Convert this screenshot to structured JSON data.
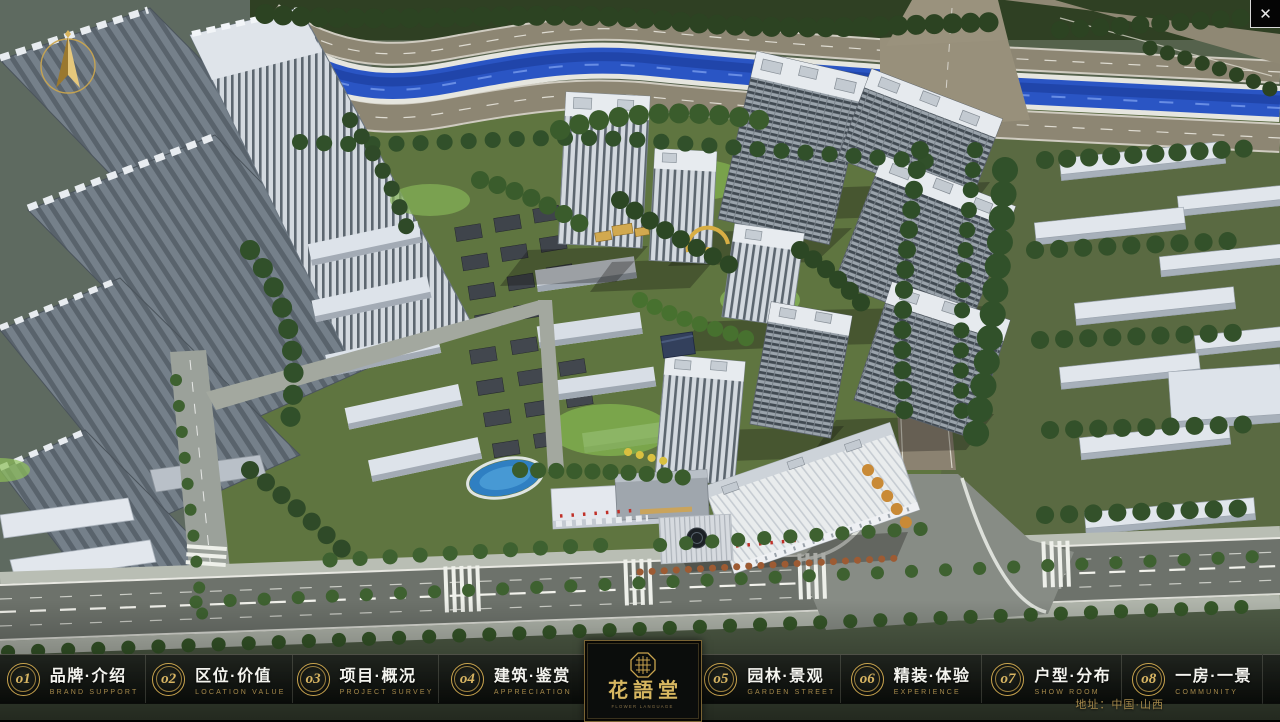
{
  "menu": {
    "items": [
      {
        "num": "o1",
        "label": "品牌·介绍",
        "sub": "BRAND SUPPORT"
      },
      {
        "num": "o2",
        "label": "区位·价值",
        "sub": "LOCATION VALUE"
      },
      {
        "num": "o3",
        "label": "项目·概况",
        "sub": "PROJECT SURVEY"
      },
      {
        "num": "o4",
        "label": "建筑·鉴赏",
        "sub": "APPRECIATION"
      },
      {
        "num": "o5",
        "label": "园林·景观",
        "sub": "GARDEN STREET"
      },
      {
        "num": "o6",
        "label": "精装·体验",
        "sub": "EXPERIENCE"
      },
      {
        "num": "o7",
        "label": "户型·分布",
        "sub": "SHOW ROOM"
      },
      {
        "num": "o8",
        "label": "一房·一景",
        "sub": "COMMUNITY"
      }
    ]
  },
  "logo": {
    "title": "花語堂",
    "tagline": "FLOWER LANGUAGE"
  },
  "footer": {
    "address": "地址：中国·山西"
  },
  "window": {
    "close_glyph": "✕"
  },
  "colors": {
    "gold": "#c9a44e",
    "bar_bg": "rgba(8,10,8,0.9)",
    "river": "#2a55c4"
  }
}
